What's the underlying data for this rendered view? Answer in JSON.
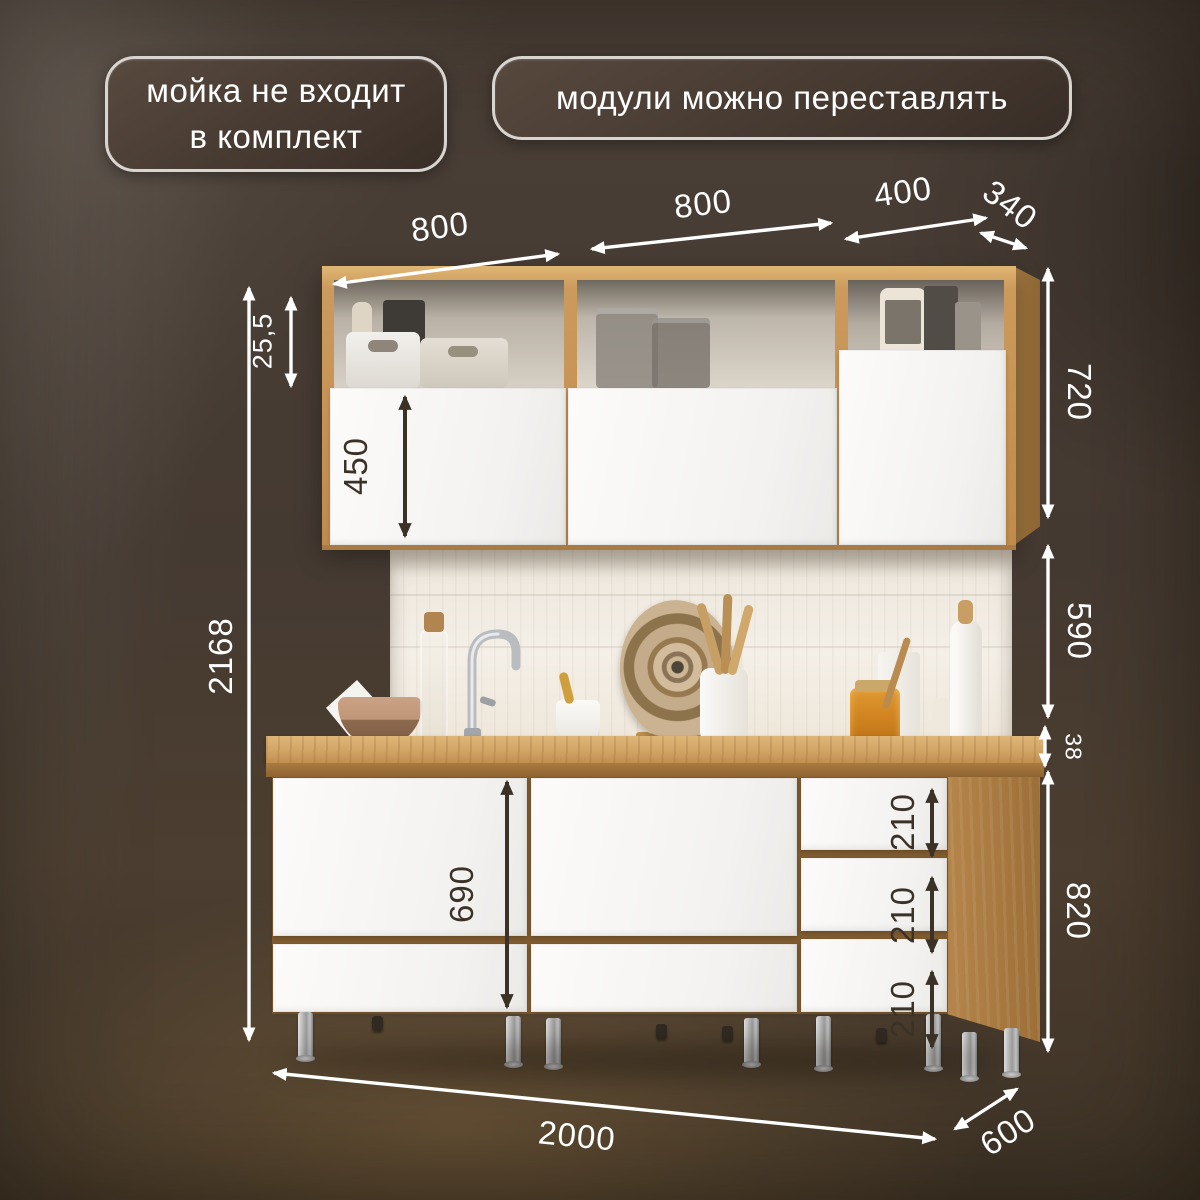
{
  "badges": {
    "sink_note": {
      "line1": "мойка не входит",
      "line2": "в комплект"
    },
    "modules_note": {
      "label": "модули можно переставлять"
    }
  },
  "dimensions": {
    "top": {
      "left_module_width": "800",
      "middle_module_width": "800",
      "right_module_width": "400",
      "upper_cabinet_depth": "340"
    },
    "left": {
      "total_height": "2168",
      "top_shelf_offset": "25,5",
      "upper_door_height": "450"
    },
    "right": {
      "upper_cabinet_height": "720",
      "backsplash_gap": "590",
      "countertop_thickness": "38",
      "base_cabinet_height": "820"
    },
    "base": {
      "door_height": "690",
      "drawer_heights": [
        "210",
        "210",
        "210"
      ]
    },
    "bottom": {
      "total_width": "2000",
      "base_depth": "600"
    }
  },
  "colors": {
    "background": "#453a32",
    "badge_border": "#d8d4d0",
    "badge_fill": "#43362e",
    "dimension_light": "#ffffff",
    "dimension_dark": "#3a3127",
    "wood": "#c79a5b",
    "fronts": "#f7f6f4"
  }
}
